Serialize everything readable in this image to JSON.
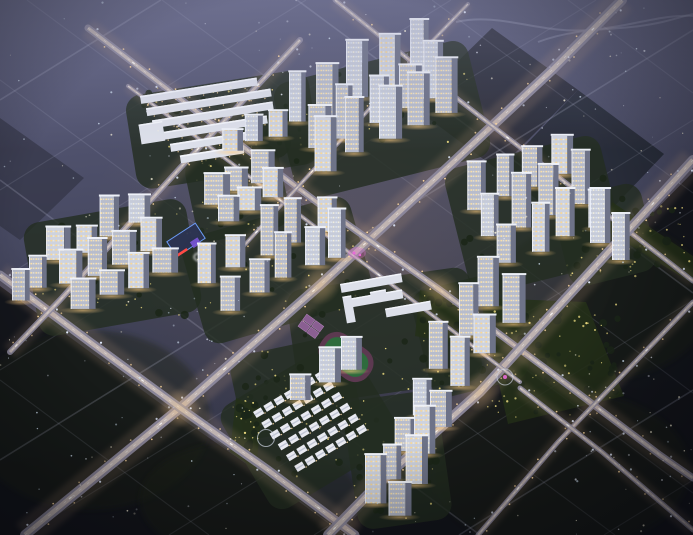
{
  "meta": {
    "description": "Night-time aerial rendering of a large residential development: clusters of lit high-rise towers, low villa rows, a school with running track, commercial strips, glowing diagonal road grid and dark surrounding parkland",
    "width": 693,
    "height": 535
  },
  "palette": {
    "sky_top": "#5e6080",
    "sky_mid": "#4c4e68",
    "sky_low": "#3b3d52",
    "sky_bottom": "#2e3042",
    "forest": "#121419",
    "forest_tint": "#1a2418",
    "road_faint": "#c9cde6",
    "road_base": "#8e8a9e",
    "road_mid": "#cdbfb8",
    "road_glow": "#c7a083",
    "lamp_warm": "#ffd9a0",
    "lamp_cool": "#e3ecff",
    "dash": "#ffffff",
    "facade_side": "#6e7388",
    "roofline": "#eef1f8",
    "edge_light": "rgba(244,247,255,0.75)",
    "ground_green": "#232d20",
    "tree": "#1b2618",
    "leaf_lamp": "#e9d87e",
    "field": "#2e6b3d",
    "track": "#5c3950",
    "court": "#8a5f92",
    "court_line": "#b487bc",
    "navy_roof": "#2c3352",
    "blue_glow": "#6fa0ff",
    "purple": "#7a54d8",
    "magenta": "#e86ad8",
    "red": "#ff4a44",
    "villa": "#e9eaf1",
    "villa_ridge": "#c2c7d6",
    "slab": "#dde0ea",
    "slab_edge": "#f2f4fa",
    "glow_warm": "rgba(255,205,130,0.8)",
    "dev_glow": "rgba(190,150,100,0.28)",
    "speckle1": "#e8ecf8",
    "speckle2": "#fdf6dd",
    "speckle3": "#cfe0f0"
  },
  "scene": {
    "parcels": [
      {
        "name": "forest-southwest",
        "pts": [
          [
            0,
            286
          ],
          [
            172,
            412
          ],
          [
            348,
            535
          ],
          [
            0,
            535
          ]
        ],
        "fill": "#121419",
        "op": 0.95
      },
      {
        "name": "forest-southeast",
        "pts": [
          [
            693,
            172
          ],
          [
            693,
            535
          ],
          [
            338,
            535
          ]
        ],
        "fill": "#121419",
        "op": 0.95
      },
      {
        "name": "parcel-northeast-1",
        "pts": [
          [
            492,
            28
          ],
          [
            578,
            90
          ],
          [
            498,
            170
          ],
          [
            412,
            106
          ]
        ],
        "fill": "#23262f",
        "op": 0.8
      },
      {
        "name": "parcel-northeast-2",
        "pts": [
          [
            578,
            90
          ],
          [
            664,
            154
          ],
          [
            586,
            236
          ],
          [
            500,
            172
          ]
        ],
        "fill": "#212530",
        "op": 0.8
      },
      {
        "name": "parcel-west",
        "pts": [
          [
            0,
            118
          ],
          [
            84,
            178
          ],
          [
            20,
            240
          ],
          [
            0,
            226
          ]
        ],
        "fill": "#2e3040",
        "op": 0.6
      }
    ],
    "forest_tint": [
      {
        "cx": 90,
        "cy": 420,
        "rx": 120,
        "ry": 90
      },
      {
        "cx": 250,
        "cy": 500,
        "rx": 110,
        "ry": 60
      },
      {
        "cx": 600,
        "cy": 300,
        "rx": 110,
        "ry": 80
      },
      {
        "cx": 560,
        "cy": 470,
        "rx": 130,
        "ry": 80
      }
    ],
    "faint_roads": [
      [
        0,
        100,
        161,
        0
      ],
      [
        0,
        190,
        306,
        0
      ],
      [
        0,
        280,
        451,
        0
      ],
      [
        0,
        370,
        596,
        0
      ],
      [
        0,
        460,
        693,
        30
      ],
      [
        24,
        535,
        693,
        120
      ],
      [
        169,
        535,
        693,
        210
      ],
      [
        314,
        535,
        693,
        300
      ],
      [
        459,
        535,
        693,
        390
      ],
      [
        604,
        535,
        693,
        480
      ],
      [
        568,
        0,
        693,
        93
      ],
      [
        432,
        0,
        693,
        193
      ],
      [
        297,
        0,
        693,
        293
      ],
      [
        162,
        0,
        693,
        393
      ],
      [
        27,
        0,
        693,
        493
      ],
      [
        0,
        80,
        615,
        535
      ],
      [
        0,
        180,
        480,
        535
      ],
      [
        0,
        280,
        345,
        535
      ],
      [
        0,
        380,
        209,
        535
      ]
    ],
    "curves": [
      "M456,22C500,12,540,34,588,30S660,14,693,16",
      "M538,42C575,28,612,30,640,26S676,18,693,14"
    ],
    "bright_roads": [
      {
        "name": "main-avenue",
        "pts": [
          [
            25,
            535
          ],
          [
            180,
            408
          ],
          [
            320,
            285
          ],
          [
            447,
            168
          ],
          [
            552,
            70
          ],
          [
            622,
            0
          ]
        ],
        "w": 10
      },
      {
        "name": "ring-southwest",
        "pts": [
          [
            0,
            275
          ],
          [
            90,
            342
          ],
          [
            180,
            408
          ],
          [
            268,
            470
          ],
          [
            355,
            535
          ]
        ],
        "w": 9
      },
      {
        "name": "central-cross",
        "pts": [
          [
            88,
            28
          ],
          [
            205,
            118
          ],
          [
            330,
            212
          ],
          [
            440,
            290
          ],
          [
            553,
            374
          ],
          [
            660,
            455
          ],
          [
            693,
            478
          ]
        ],
        "w": 7
      },
      {
        "name": "north-boundary",
        "pts": [
          [
            335,
            0
          ],
          [
            459,
            100
          ],
          [
            570,
            186
          ],
          [
            670,
            263
          ],
          [
            693,
            281
          ]
        ],
        "w": 5
      },
      {
        "name": "east-avenue",
        "pts": [
          [
            693,
            160
          ],
          [
            590,
            272
          ],
          [
            480,
            392
          ],
          [
            380,
            482
          ],
          [
            328,
            535
          ]
        ],
        "w": 10
      },
      {
        "name": "southeast-minor",
        "pts": [
          [
            693,
            302
          ],
          [
            640,
            357
          ],
          [
            558,
            442
          ],
          [
            478,
            535
          ]
        ],
        "w": 5
      },
      {
        "name": "southeast-cross",
        "pts": [
          [
            520,
            388
          ],
          [
            602,
            452
          ],
          [
            693,
            530
          ]
        ],
        "w": 5
      },
      {
        "name": "west-boundary",
        "pts": [
          [
            300,
            40
          ],
          [
            240,
            104
          ],
          [
            180,
            168
          ],
          [
            120,
            234
          ],
          [
            60,
            300
          ],
          [
            10,
            352
          ]
        ],
        "w": 6
      },
      {
        "name": "inner-north",
        "pts": [
          [
            468,
            4
          ],
          [
            412,
            62
          ],
          [
            352,
            128
          ],
          [
            295,
            190
          ],
          [
            240,
            250
          ]
        ],
        "w": 4
      },
      {
        "name": "inner-mid",
        "pts": [
          [
            128,
            86
          ],
          [
            230,
            162
          ],
          [
            330,
            238
          ],
          [
            428,
            312
          ],
          [
            520,
            382
          ]
        ],
        "w": 4
      }
    ],
    "crossing_glows": [
      [
        180,
        408
      ],
      [
        320,
        285
      ],
      [
        440,
        290
      ],
      [
        480,
        392
      ],
      [
        330,
        212
      ]
    ],
    "grounds": [
      [
        282,
        60,
        200,
        120,
        -14
      ],
      [
        455,
        150,
        160,
        130,
        -14
      ],
      [
        190,
        215,
        175,
        110,
        -16
      ],
      [
        190,
        150,
        95,
        85,
        -12
      ],
      [
        215,
        118,
        75,
        45,
        -12
      ],
      [
        30,
        210,
        165,
        115,
        -10
      ],
      [
        350,
        395,
        95,
        130,
        -8
      ],
      [
        420,
        280,
        100,
        110,
        -14
      ],
      [
        235,
        345,
        120,
        85,
        -12
      ],
      [
        235,
        365,
        150,
        120,
        -31
      ],
      [
        292,
        278,
        185,
        115,
        -8
      ],
      [
        130,
        82,
        185,
        95,
        -9
      ],
      [
        560,
        190,
        90,
        90,
        -14
      ]
    ],
    "parks": [
      {
        "name": "park-east",
        "pts": [
          [
            480,
            298
          ],
          [
            586,
            302
          ],
          [
            624,
            396
          ],
          [
            508,
            424
          ]
        ],
        "trees": 30
      },
      {
        "name": "park-northeast-strip",
        "pts": [
          [
            612,
            202
          ],
          [
            693,
            256
          ],
          [
            693,
            284
          ],
          [
            606,
            230
          ]
        ],
        "trees": 12
      },
      {
        "name": "park-school-east",
        "pts": [
          [
            420,
            290
          ],
          [
            470,
            300
          ],
          [
            462,
            345
          ],
          [
            415,
            336
          ]
        ],
        "trees": 10
      },
      {
        "name": "park-villa-west",
        "pts": [
          [
            236,
            398
          ],
          [
            262,
            408
          ],
          [
            256,
            470
          ],
          [
            230,
            452
          ]
        ],
        "trees": 10
      }
    ],
    "clusters": [
      {
        "name": "top-towers",
        "ox": 290,
        "oy": 125,
        "u": [
          0.92,
          -0.39
        ],
        "v": [
          0.55,
          0.84
        ],
        "cols": 5,
        "rows": 3,
        "sp": 33,
        "rs": 26,
        "wmin": 12,
        "wmax": 17,
        "hmin": 40,
        "hmax": 62
      },
      {
        "name": "right-towers",
        "ox": 468,
        "oy": 212,
        "u": [
          0.92,
          -0.39
        ],
        "v": [
          0.55,
          0.84
        ],
        "cols": 4,
        "rows": 3,
        "sp": 31,
        "rs": 29,
        "wmin": 12,
        "wmax": 16,
        "hmin": 36,
        "hmax": 56
      },
      {
        "name": "center-towers",
        "ox": 218,
        "oy": 306,
        "u": [
          0.92,
          -0.39
        ],
        "v": [
          -0.55,
          -0.84
        ],
        "cols": 5,
        "rows": 2,
        "sp": 31,
        "rs": 30,
        "wmin": 12,
        "wmax": 16,
        "hmin": 30,
        "hmax": 50
      },
      {
        "name": "west-mid",
        "ox": 202,
        "oy": 201,
        "u": [
          0.92,
          -0.39
        ],
        "v": [
          0.55,
          0.84
        ],
        "cols": 3,
        "rows": 2,
        "sp": 27,
        "rs": 23,
        "wmin": 15,
        "wmax": 19,
        "hmin": 20,
        "hmax": 32
      },
      {
        "name": "north-mid",
        "ox": 224,
        "oy": 152,
        "u": [
          0.92,
          -0.39
        ],
        "v": [
          0.55,
          0.84
        ],
        "cols": 3,
        "rows": 1,
        "sp": 25,
        "rs": 20,
        "wmin": 13,
        "wmax": 16,
        "hmin": 20,
        "hmax": 30
      },
      {
        "name": "left-towers",
        "ox": 44,
        "oy": 262,
        "u": [
          0.92,
          -0.39
        ],
        "v": [
          0.5,
          0.87
        ],
        "cols": 4,
        "rows": 3,
        "sp": 31,
        "rs": 27,
        "wmin": 14,
        "wmax": 19,
        "hmin": 22,
        "hmax": 40
      },
      {
        "name": "south-towers",
        "ox": 368,
        "oy": 506,
        "u": [
          0.45,
          -0.89
        ],
        "v": [
          0.89,
          0.45
        ],
        "cols": 4,
        "rows": 2,
        "sp": 33,
        "rs": 24,
        "wmin": 13,
        "wmax": 17,
        "hmin": 32,
        "hmax": 50
      },
      {
        "name": "southeast-towers",
        "ox": 433,
        "oy": 369,
        "u": [
          0.6,
          -0.8
        ],
        "v": [
          0.8,
          0.6
        ],
        "cols": 3,
        "rows": 2,
        "sp": 37,
        "rs": 26,
        "wmin": 13,
        "wmax": 17,
        "hmin": 34,
        "hmax": 52
      },
      {
        "name": "villa-edge-slabs",
        "ox": 292,
        "oy": 403,
        "u": [
          0.8,
          -0.6
        ],
        "v": [
          0.6,
          0.8
        ],
        "cols": 3,
        "rows": 1,
        "sp": 28,
        "rs": 20,
        "wmin": 15,
        "wmax": 18,
        "hmin": 24,
        "hmax": 36
      },
      {
        "name": "far-left-pair",
        "ox": 8,
        "oy": 300,
        "u": [
          0.92,
          -0.39
        ],
        "v": [
          0.55,
          0.84
        ],
        "cols": 2,
        "rows": 1,
        "sp": 22,
        "rs": 20,
        "wmin": 12,
        "wmax": 15,
        "hmin": 24,
        "hmax": 34
      }
    ],
    "offices": [
      {
        "x": 590,
        "y": 243,
        "w": 15,
        "h": 54
      },
      {
        "x": 612,
        "y": 260,
        "w": 13,
        "h": 46
      }
    ],
    "villas": {
      "x": 253,
      "y": 412,
      "rot": -31,
      "rows": 6,
      "cols": 7,
      "sx": 12,
      "sy": 13.5,
      "hw": 9,
      "hh": 7
    },
    "commercial": {
      "x": 140,
      "y": 96,
      "rot": -9,
      "h": 8,
      "rows": [
        [
          0,
          0,
          118
        ],
        [
          4,
          13,
          126
        ],
        [
          8,
          26,
          122
        ],
        [
          14,
          39,
          108
        ],
        [
          22,
          52,
          88
        ],
        [
          30,
          65,
          64
        ]
      ],
      "block": [
        -6,
        28,
        24,
        20
      ]
    },
    "school": {
      "x": 340,
      "y": 284,
      "rot": -10,
      "slabs": [
        [
          0,
          0,
          62,
          9
        ],
        [
          8,
          16,
          52,
          9
        ],
        [
          40,
          32,
          46,
          9
        ],
        [
          0,
          13,
          9,
          27
        ],
        [
          28,
          13,
          16,
          11
        ]
      ]
    },
    "field": {
      "x": 346,
      "y": 357,
      "rot": 36,
      "w": 58,
      "h": 36
    },
    "courts": {
      "x": 311,
      "y": 327,
      "rot": 36
    },
    "features": {
      "mall": {
        "x": 186,
        "y": 240,
        "rot": -33
      },
      "ring_plaza": [
        201,
        257
      ],
      "pink_plaza": [
        357,
        253
      ],
      "villa_circle": [
        266,
        438
      ],
      "park_circle": [
        505,
        377
      ]
    },
    "speckles": [
      [
        0,
        0,
        340,
        265,
        55
      ],
      [
        350,
        0,
        340,
        115,
        35
      ],
      [
        490,
        95,
        200,
        200,
        40
      ],
      [
        0,
        290,
        255,
        245,
        60
      ],
      [
        565,
        335,
        128,
        200,
        42
      ],
      [
        360,
        498,
        180,
        37,
        10
      ],
      [
        250,
        0,
        90,
        80,
        8
      ]
    ]
  }
}
